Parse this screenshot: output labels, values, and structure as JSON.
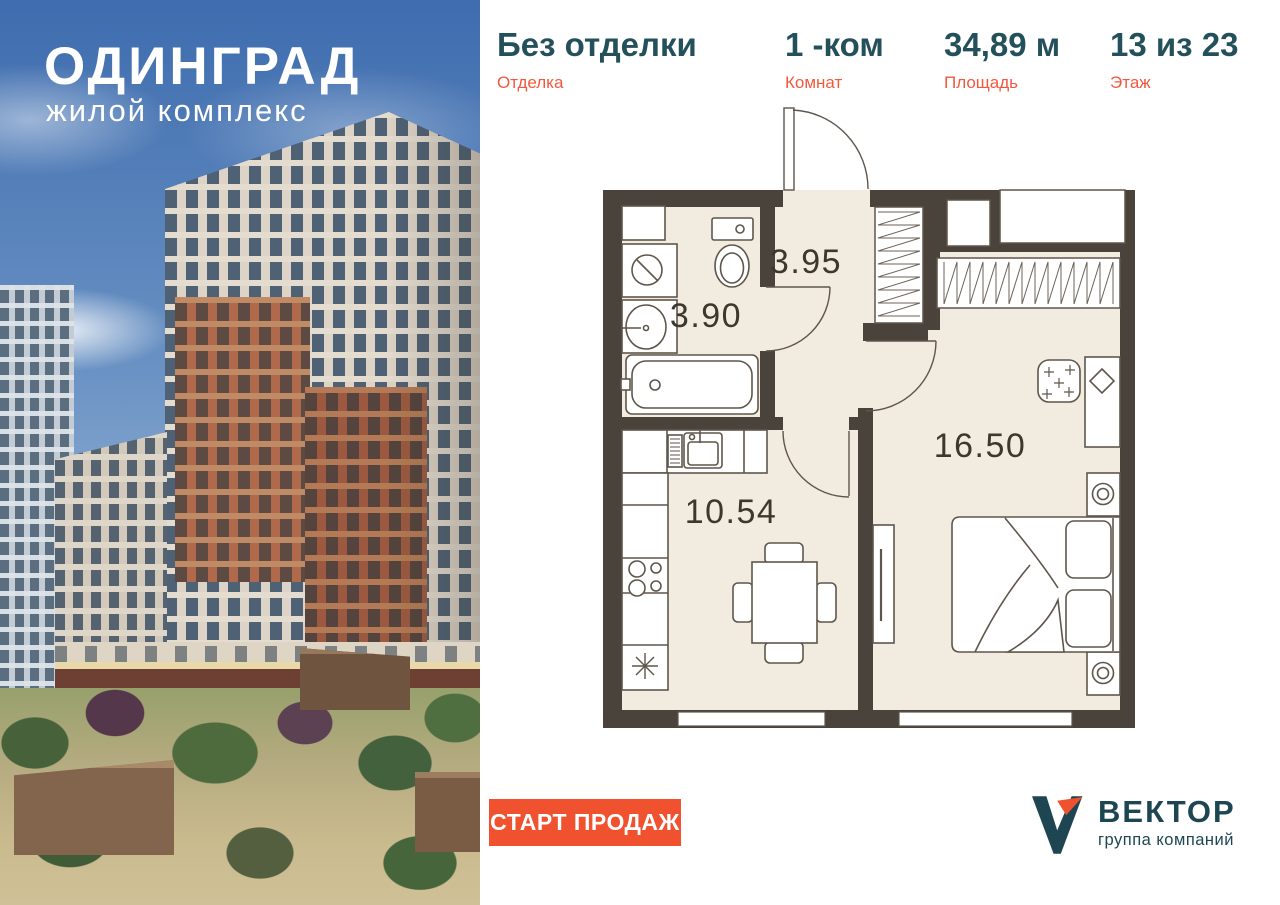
{
  "hero": {
    "title": "ОДИНГРАД",
    "subtitle": "жилой комплекс"
  },
  "header": {
    "stats": [
      {
        "value": "Без отделки",
        "label": "Отделка"
      },
      {
        "value": "1 -ком",
        "label": "Комнат"
      },
      {
        "value": "34,89 м",
        "label": "Площадь"
      },
      {
        "value": "13 из 23",
        "label": "Этаж"
      }
    ]
  },
  "plan": {
    "rooms": [
      {
        "name": "hallway",
        "area": "3.95"
      },
      {
        "name": "bathroom",
        "area": "3.90"
      },
      {
        "name": "kitchen",
        "area": "10.54"
      },
      {
        "name": "bedroom",
        "area": "16.50"
      }
    ]
  },
  "footer": {
    "cta_label": "СТАРТ ПРОДАЖ",
    "logo": {
      "name": "ВЕКТОР",
      "tagline": "группа компаний"
    }
  },
  "colors": {
    "accent_orange": "#f0512f",
    "teal": "#24505c",
    "wall": "#4a433b",
    "floor": "#f2ebdf"
  }
}
